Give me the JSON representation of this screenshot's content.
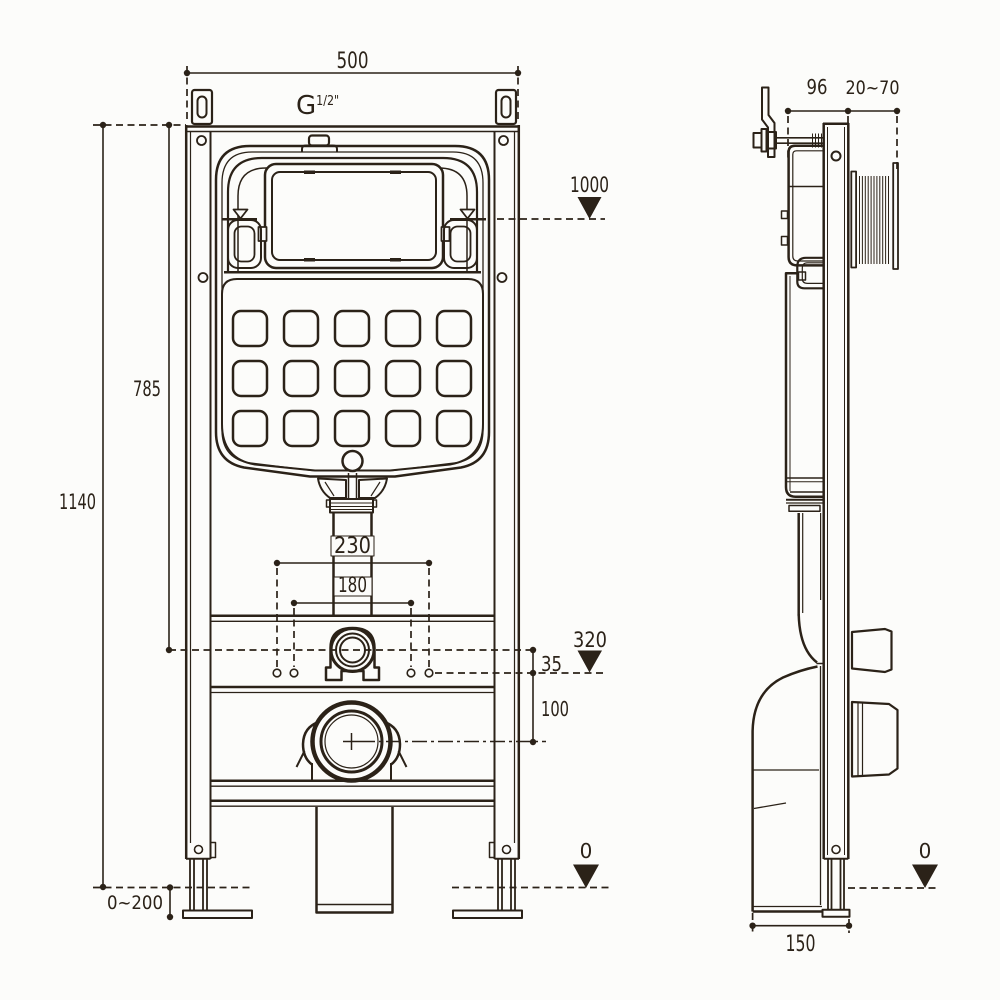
{
  "front_view": {
    "thread": {
      "prefix": "G",
      "size": "1/2\""
    },
    "dims": {
      "width": "500",
      "total_height": "1140",
      "valve_axis_height": "785",
      "water_level": "1000",
      "pipe_clearance": "230",
      "fixing_centers": "180",
      "outlet_level": "320",
      "offset": "35",
      "drain_axis": "100",
      "leg_adjustment": "0~200",
      "floor_level": "0"
    }
  },
  "side_view": {
    "dims": {
      "frame_depth": "96",
      "wall_range": "20~70",
      "floor_level": "0",
      "base_depth": "150"
    }
  },
  "colors": {
    "line": "#2b2218",
    "background": "#fcfcfa"
  }
}
